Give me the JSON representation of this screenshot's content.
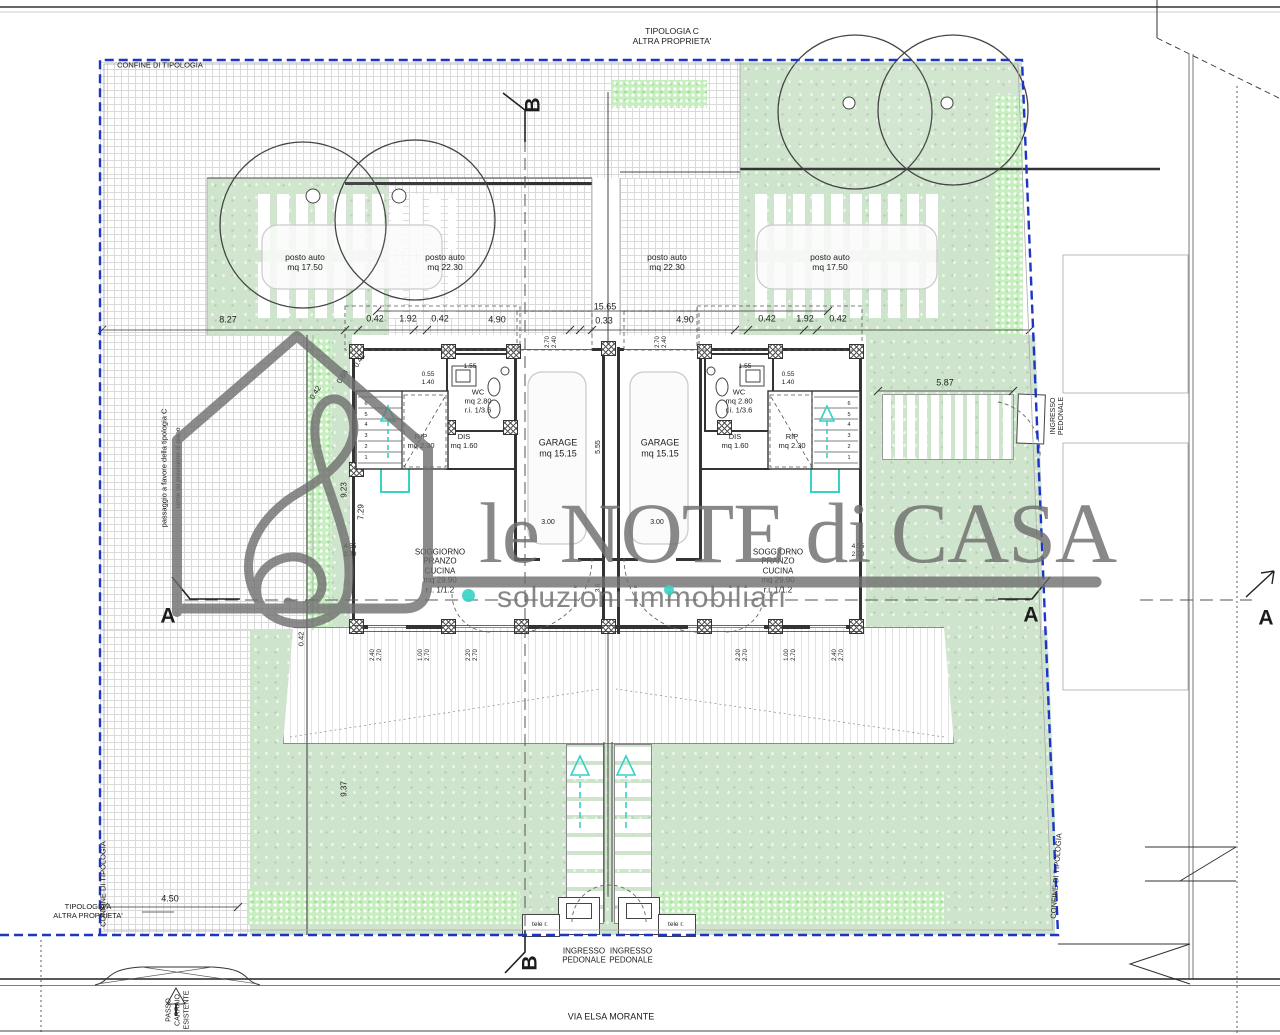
{
  "watermark": {
    "line1": "le NOTE di CASA",
    "line2": "soluzioni immobiliari"
  },
  "colors": {
    "boundary_blue": "#1d35c6",
    "garden_green": "#cfe4cd",
    "hedge_green": "#c6eebf",
    "teal_accent": "#35d2c5",
    "watermark_gray": "#6f6f6f"
  },
  "labels": [
    {
      "n": "label-tipologia-c",
      "t": "TIPOLOGIA C\nALTRA PROPRIETA'",
      "x": 672,
      "y": 36,
      "fs": 8.5
    },
    {
      "n": "label-confine-top",
      "t": "CONFINE DI TIPOLOGIA",
      "x": 160,
      "y": 66,
      "fs": 7.5
    },
    {
      "n": "label-confine-bottom-left",
      "t": "CONFINE DI TIPOLOGIA",
      "x": 104,
      "y": 884,
      "fs": 7.5,
      "r": -90
    },
    {
      "n": "label-confine-right",
      "t": "CONFINE DI TIPOLOGIA",
      "x": 1057,
      "y": 876,
      "fs": 7.5,
      "r": -86
    },
    {
      "n": "label-passaggio",
      "t": "passaggio a favore della tipologia C",
      "x": 165,
      "y": 468,
      "fs": 7.5,
      "r": -90
    },
    {
      "n": "label-previsione",
      "t": "come da previsione di piano",
      "x": 179,
      "y": 468,
      "fs": 6.5,
      "r": -90
    },
    {
      "n": "label-tipologia-a",
      "t": "TIPOLOGIA A\nALTRA PROPRIETA'",
      "x": 88,
      "y": 912,
      "fs": 7.5
    },
    {
      "n": "label-passo-carraio",
      "t": "PASSO\nCARRAIO\nESISTENTE",
      "x": 178,
      "y": 1010,
      "fs": 7,
      "r": -90,
      "lh": "1.3"
    },
    {
      "n": "label-via-elsa-morante",
      "t": "VIA ELSA MORANTE",
      "x": 611,
      "y": 1017,
      "fs": 9
    }
  ],
  "parking": [
    {
      "n": "parking-left-covered",
      "t": "posto auto\nmq 17.50",
      "x": 305,
      "y": 262,
      "fs": 8.5
    },
    {
      "n": "parking-left-open",
      "t": "posto auto\nmq 22.30",
      "x": 445,
      "y": 262,
      "fs": 8.5
    },
    {
      "n": "parking-right-open",
      "t": "posto auto\nmq 22.30",
      "x": 667,
      "y": 262,
      "fs": 8.5
    },
    {
      "n": "parking-right-covered",
      "t": "posto auto\nmq 17.50",
      "x": 830,
      "y": 262,
      "fs": 8.5
    }
  ],
  "rooms": [
    {
      "n": "room-garage-left",
      "t": "GARAGE\nmq 15.15",
      "x": 558,
      "y": 448,
      "fs": 9
    },
    {
      "n": "room-garage-right",
      "t": "GARAGE\nmq 15.15",
      "x": 660,
      "y": 448,
      "fs": 9
    },
    {
      "n": "room-wc-left",
      "t": "WC\nmq 2.80\nr.i. 1/3.6",
      "x": 478,
      "y": 402,
      "fs": 7.5
    },
    {
      "n": "room-wc-right",
      "t": "WC\nmq 2.80\nr.i. 1/3.6",
      "x": 739,
      "y": 402,
      "fs": 7.5
    },
    {
      "n": "room-dis-left",
      "t": "DIS\nmq 1.60",
      "x": 464,
      "y": 442,
      "fs": 7.5
    },
    {
      "n": "room-dis-right",
      "t": "DIS\nmq 1.60",
      "x": 735,
      "y": 442,
      "fs": 7.5
    },
    {
      "n": "room-rip-left",
      "t": "RIP\nmq 2.30",
      "x": 421,
      "y": 442,
      "fs": 7.5
    },
    {
      "n": "room-rip-right",
      "t": "RIP\nmq 2.30",
      "x": 792,
      "y": 442,
      "fs": 7.5
    },
    {
      "n": "room-soggiorno-left",
      "t": "SOGGIORNO\nPRANZO\nCUCINA\nmq 29.90\nr.i. 1/1.2",
      "x": 440,
      "y": 571,
      "fs": 8
    },
    {
      "n": "room-soggiorno-right",
      "t": "SOGGIORNO\nPRANZO\nCUCINA\nmq 29.90\nr.i. 1/1.2",
      "x": 778,
      "y": 571,
      "fs": 8
    }
  ],
  "dimensions": [
    {
      "n": "dim",
      "t": "8.27",
      "x": 228,
      "y": 320
    },
    {
      "n": "dim",
      "t": "0.42",
      "x": 375,
      "y": 319
    },
    {
      "n": "dim",
      "t": "1.92",
      "x": 408,
      "y": 319
    },
    {
      "n": "dim",
      "t": "0.42",
      "x": 440,
      "y": 319
    },
    {
      "n": "dim",
      "t": "4.90",
      "x": 497,
      "y": 320
    },
    {
      "n": "dim",
      "t": "15.65",
      "x": 605,
      "y": 307
    },
    {
      "n": "dim",
      "t": "0.33",
      "x": 604,
      "y": 321
    },
    {
      "n": "dim",
      "t": "4.90",
      "x": 685,
      "y": 320
    },
    {
      "n": "dim",
      "t": "0.42",
      "x": 767,
      "y": 319
    },
    {
      "n": "dim",
      "t": "1.92",
      "x": 805,
      "y": 319
    },
    {
      "n": "dim",
      "t": "0.42",
      "x": 838,
      "y": 319
    },
    {
      "n": "dim",
      "t": "5.87",
      "x": 945,
      "y": 383
    },
    {
      "n": "dim",
      "t": "4.50",
      "x": 170,
      "y": 899
    },
    {
      "n": "dim",
      "t": "0.42",
      "x": 360,
      "y": 361,
      "r": -58,
      "fs": 7.5
    },
    {
      "n": "dim",
      "t": "0.68",
      "x": 343,
      "y": 377,
      "r": -58,
      "fs": 7.5
    },
    {
      "n": "dim",
      "t": "0.42",
      "x": 316,
      "y": 393,
      "r": -58,
      "fs": 7.5
    },
    {
      "n": "dim",
      "t": "9.23",
      "x": 344,
      "y": 490,
      "r": -90,
      "fs": 8
    },
    {
      "n": "dim",
      "t": "7.29",
      "x": 361,
      "y": 512,
      "r": -90,
      "fs": 8
    },
    {
      "n": "dim",
      "t": "9.37",
      "x": 344,
      "y": 789,
      "r": -90,
      "fs": 8
    },
    {
      "n": "dim",
      "t": "0.42",
      "x": 302,
      "y": 639,
      "r": -90,
      "fs": 7.5
    },
    {
      "n": "dim",
      "t": "0.55\n1.40",
      "x": 428,
      "y": 379,
      "fs": 6.5,
      "lh": "1.2"
    },
    {
      "n": "dim",
      "t": "0.55\n1.40",
      "x": 788,
      "y": 379,
      "fs": 6.5,
      "lh": "1.2"
    },
    {
      "n": "dim",
      "t": "1.55",
      "x": 470,
      "y": 367,
      "fs": 6.5
    },
    {
      "n": "dim",
      "t": "1.55",
      "x": 745,
      "y": 367,
      "fs": 6.5
    },
    {
      "n": "dim",
      "t": "3.00",
      "x": 548,
      "y": 523,
      "fs": 7
    },
    {
      "n": "dim",
      "t": "3.00",
      "x": 657,
      "y": 523,
      "fs": 7
    },
    {
      "n": "dim",
      "t": "5.55",
      "x": 599,
      "y": 447,
      "r": -90,
      "fs": 7
    },
    {
      "n": "dim",
      "t": "2.70\n2.40",
      "x": 552,
      "y": 342,
      "r": -90,
      "fs": 6,
      "lh": "1.2"
    },
    {
      "n": "dim",
      "t": "2.70\n2.40",
      "x": 662,
      "y": 342,
      "r": -90,
      "fs": 6,
      "lh": "1.2"
    },
    {
      "n": "dim",
      "t": "4.55\n2.70",
      "x": 350,
      "y": 551,
      "fs": 6.5,
      "lh": "1.2"
    },
    {
      "n": "dim",
      "t": "4.55\n2.70",
      "x": 858,
      "y": 551,
      "fs": 6.5,
      "lh": "1.2"
    },
    {
      "n": "dim",
      "t": "3.6",
      "x": 599,
      "y": 588,
      "r": -90,
      "fs": 6
    },
    {
      "n": "dim",
      "t": "2.40\n2.70",
      "x": 377,
      "y": 655,
      "r": -90,
      "fs": 6,
      "lh": "1.2"
    },
    {
      "n": "dim",
      "t": "1.00\n2.70",
      "x": 425,
      "y": 655,
      "r": -90,
      "fs": 6,
      "lh": "1.2"
    },
    {
      "n": "dim",
      "t": "2.20\n2.70",
      "x": 473,
      "y": 655,
      "r": -90,
      "fs": 6,
      "lh": "1.2"
    },
    {
      "n": "dim",
      "t": "2.20\n2.70",
      "x": 743,
      "y": 655,
      "r": -90,
      "fs": 6,
      "lh": "1.2"
    },
    {
      "n": "dim",
      "t": "1.00\n2.70",
      "x": 791,
      "y": 655,
      "r": -90,
      "fs": 6,
      "lh": "1.2"
    },
    {
      "n": "dim",
      "t": "2.40\n2.70",
      "x": 839,
      "y": 655,
      "r": -90,
      "fs": 6,
      "lh": "1.2"
    },
    {
      "n": "stair-numbers",
      "t": "6\n5\n4\n3\n2\n1",
      "x": 366,
      "y": 431,
      "fs": 5.5,
      "lh": "1.95"
    },
    {
      "n": "stair-numbers",
      "t": "6\n5\n4\n3\n2\n1",
      "x": 849,
      "y": 431,
      "fs": 5.5,
      "lh": "1.95"
    }
  ],
  "entrances": [
    {
      "n": "label-ingresso-pedonale-left",
      "t": "INGRESSO\nPEDONALE",
      "x": 584,
      "y": 956,
      "fs": 8
    },
    {
      "n": "label-ingresso-pedonale-right",
      "t": "INGRESSO\nPEDONALE",
      "x": 631,
      "y": 956,
      "fs": 8
    },
    {
      "n": "label-ingresso-pedonale-side",
      "t": "INGRESSO\nPEDONALE",
      "x": 1058,
      "y": 416,
      "fs": 7,
      "r": -90
    },
    {
      "n": "label-tele-r-left",
      "t": "tele r.",
      "x": 540,
      "y": 925,
      "fs": 6.5
    },
    {
      "n": "label-tele-r-right",
      "t": "tele r.",
      "x": 676,
      "y": 925,
      "fs": 6.5
    }
  ],
  "sections": [
    {
      "n": "section-marker-a-left",
      "t": "A",
      "x": 168,
      "y": 617,
      "fs": 21,
      "b": 1
    },
    {
      "n": "section-marker-a-mid",
      "t": "A",
      "x": 1031,
      "y": 616,
      "fs": 21,
      "b": 1
    },
    {
      "n": "section-marker-a-far-right",
      "t": "A",
      "x": 1266,
      "y": 619,
      "fs": 21,
      "b": 1
    },
    {
      "n": "section-marker-b-top",
      "t": "B",
      "x": 534,
      "y": 105,
      "fs": 21,
      "b": 1,
      "r": -90
    },
    {
      "n": "section-marker-b-bottom",
      "t": "B",
      "x": 531,
      "y": 963,
      "fs": 21,
      "b": 1,
      "r": -90
    }
  ]
}
